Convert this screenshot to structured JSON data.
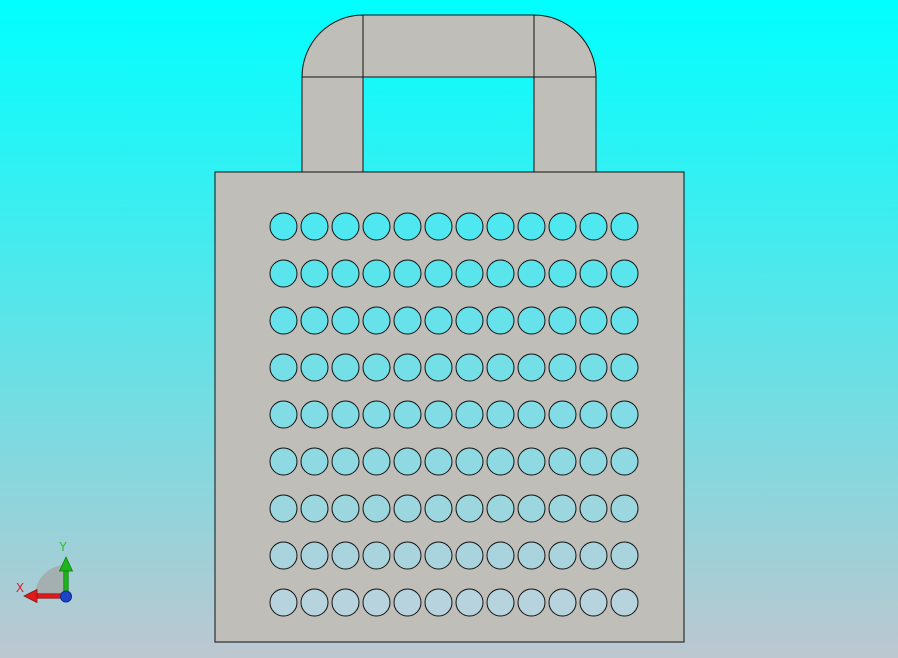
{
  "viewport": {
    "width": 898,
    "height": 658,
    "background_top": "#00ffff",
    "background_bottom": "#bdc7d0"
  },
  "model": {
    "part_name": "perforated-plate-with-handle",
    "face_color": "#bfbeb9",
    "edge_color": "#111111",
    "holes": {
      "rows": 9,
      "cols": 12,
      "start_cx": 283.5,
      "start_cy": 226.5,
      "dx": 31,
      "dy": 47,
      "r": 13.5,
      "row_colors": [
        "#4fe8f0",
        "#5ae5ed",
        "#67e2ea",
        "#74dfe7",
        "#81dce5",
        "#8fd9e2",
        "#9cd7e0",
        "#a9d4de",
        "#b6d3de"
      ]
    }
  },
  "triad": {
    "x_label": "X",
    "y_label": "Y",
    "x_axis_color": "#e01a1a",
    "x_axis_edge": "#8a1010",
    "x_label_color": "#cf2233",
    "y_axis_color": "#1db41d",
    "y_axis_edge": "#0c7a0c",
    "y_label_color": "#2ebf2e",
    "origin_dot_color": "#1e45c8",
    "origin_dot_edge": "#12288a",
    "sector_color": "#a2a7a6"
  }
}
